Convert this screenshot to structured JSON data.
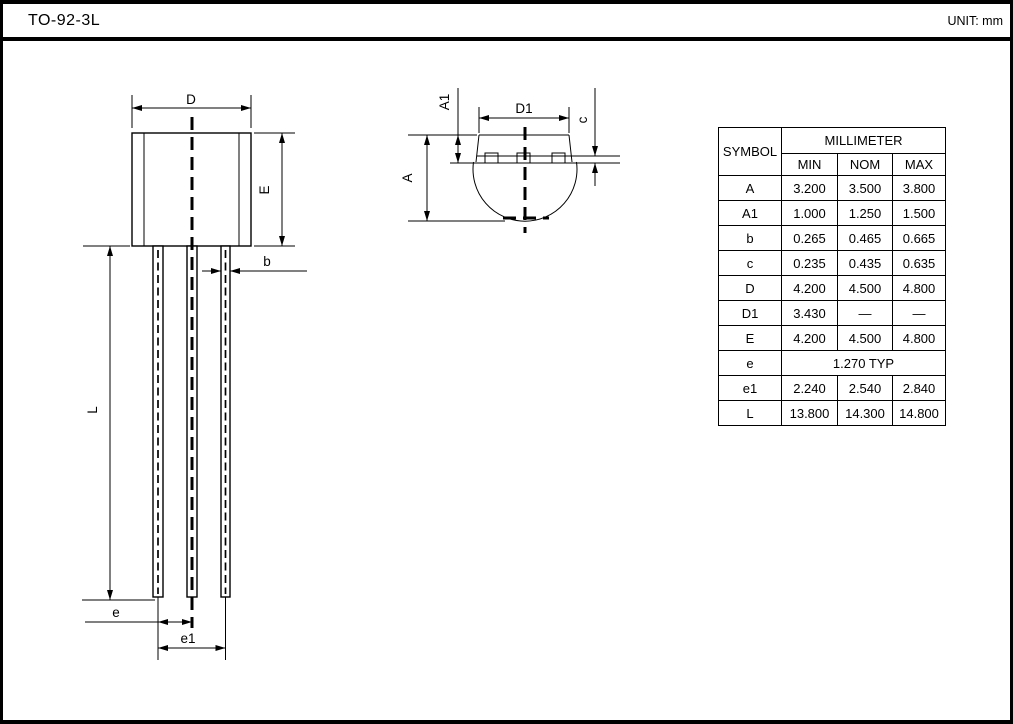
{
  "header": {
    "title": "TO-92-3L",
    "unit": "UNIT: mm"
  },
  "front_view": {
    "d_label": "D",
    "e_label": "E",
    "b_label": "b",
    "l_label": "L",
    "e_pitch_label": "e",
    "e1_pitch_label": "e1"
  },
  "top_view": {
    "a1_label": "A1",
    "d1_label": "D1",
    "c_label": "c",
    "a_label": "A"
  },
  "table": {
    "symbol_header": "SYMBOL",
    "unit_header": "MILLIMETER",
    "col_headers": [
      "MIN",
      "NOM",
      "MAX"
    ],
    "rows": [
      {
        "symbol": "A",
        "min": "3.200",
        "nom": "3.500",
        "max": "3.800"
      },
      {
        "symbol": "A1",
        "min": "1.000",
        "nom": "1.250",
        "max": "1.500"
      },
      {
        "symbol": "b",
        "min": "0.265",
        "nom": "0.465",
        "max": "0.665"
      },
      {
        "symbol": "c",
        "min": "0.235",
        "nom": "0.435",
        "max": "0.635"
      },
      {
        "symbol": "D",
        "min": "4.200",
        "nom": "4.500",
        "max": "4.800"
      },
      {
        "symbol": "D1",
        "min": "3.430",
        "nom": "—",
        "max": "—"
      },
      {
        "symbol": "E",
        "min": "4.200",
        "nom": "4.500",
        "max": "4.800"
      },
      {
        "symbol": "e",
        "span": "1.270 TYP"
      },
      {
        "symbol": "e1",
        "min": "2.240",
        "nom": "2.540",
        "max": "2.840"
      },
      {
        "symbol": "L",
        "min": "13.800",
        "nom": "14.300",
        "max": "14.800"
      }
    ]
  },
  "colors": {
    "line": "#000000",
    "background": "#ffffff"
  }
}
